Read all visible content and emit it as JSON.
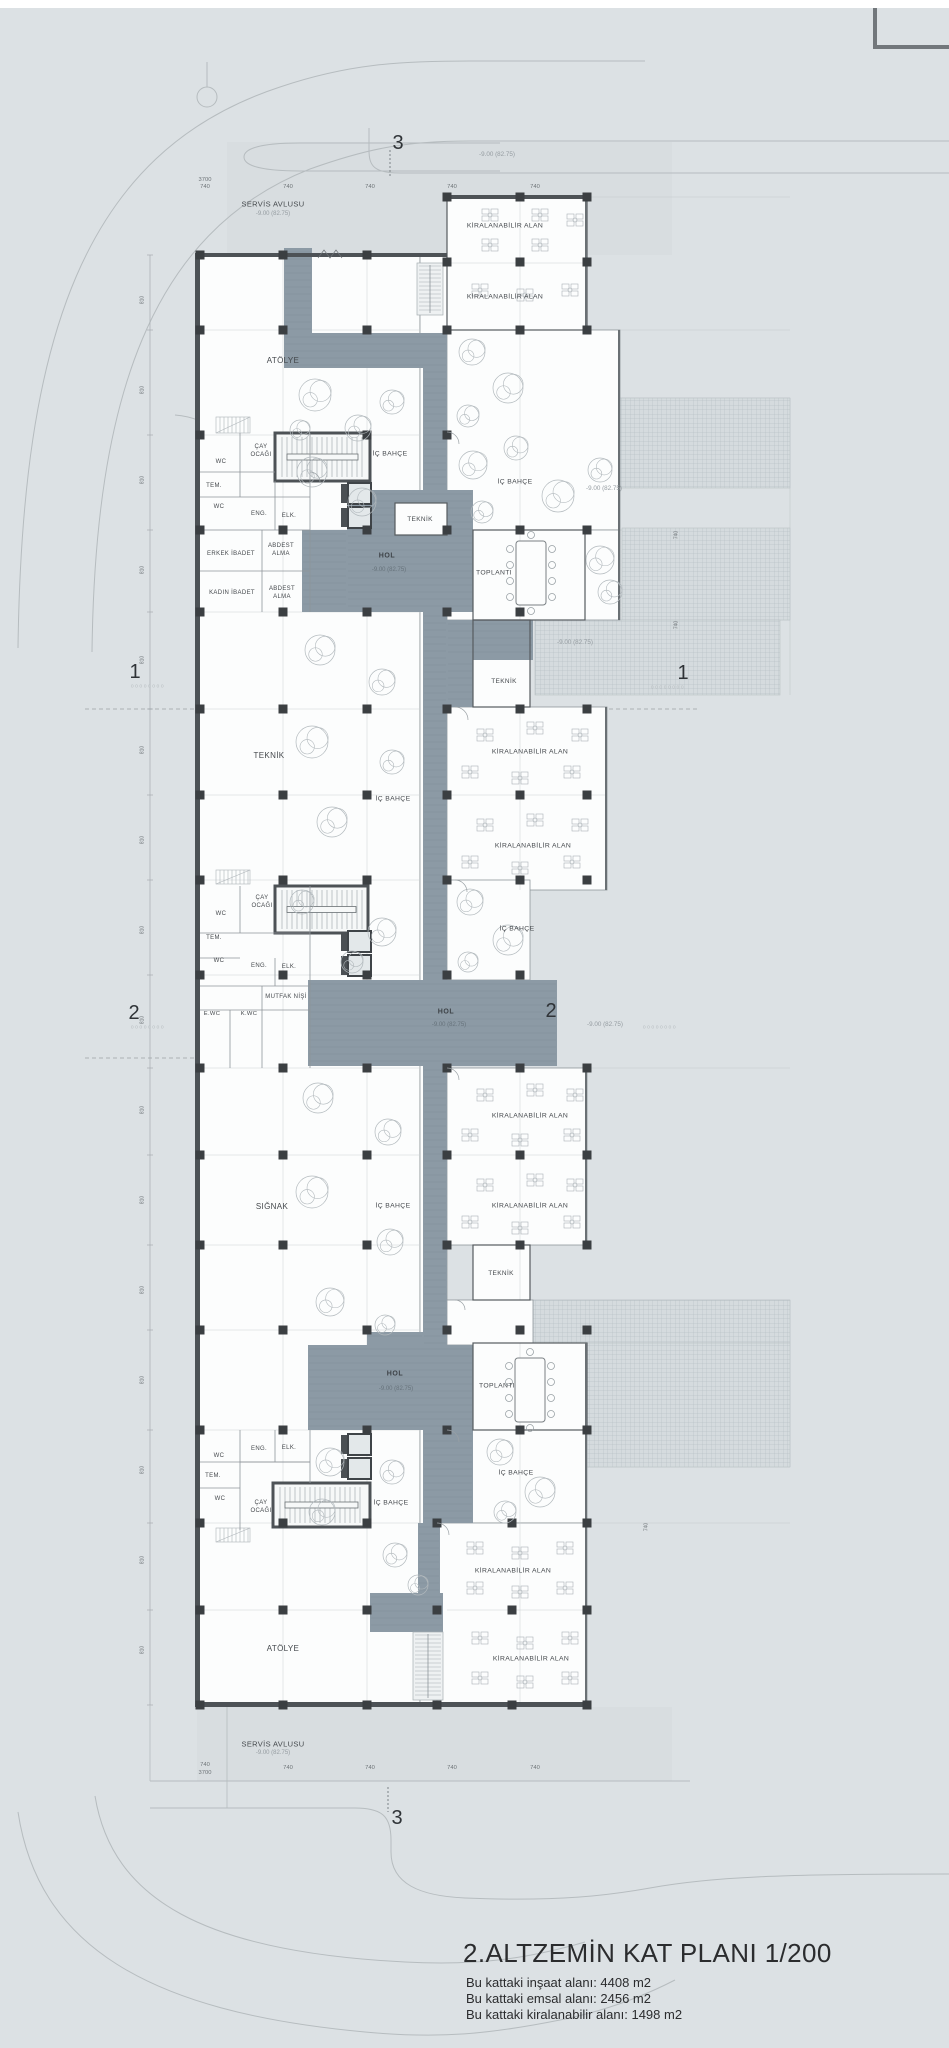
{
  "title_block": {
    "title": "2.ALTZEMİN KAT PLANI 1/200",
    "lines": [
      "Bu kattaki inşaat alanı: 4408 m2",
      "Bu kattaki emsal alanı: 2456 m2",
      "Bu kattaki kiralanabilir alanı: 1498 m2"
    ]
  },
  "colors": {
    "background": "#dce1e4",
    "room_fill": "#fcfdfd",
    "corridor": "#8c9aa5",
    "wall": "#4d5256",
    "column": "#3b3f42",
    "road_line": "#b6bcbf",
    "hatch_line": "#aeb7bc",
    "text": "#45494d"
  },
  "grid_markers": [
    {
      "t": "3",
      "x": 398,
      "y": 143
    },
    {
      "t": "3",
      "x": 397,
      "y": 1818
    },
    {
      "t": "1",
      "x": 135,
      "y": 672
    },
    {
      "t": "1",
      "x": 683,
      "y": 673
    },
    {
      "t": "2",
      "x": 134,
      "y": 1013
    },
    {
      "t": "2",
      "x": 551,
      "y": 1011
    }
  ],
  "labels": [
    {
      "t": "-9.00 (82.75)",
      "x": 497,
      "y": 155,
      "s": 6.3,
      "c": "muted"
    },
    {
      "t": "3700",
      "x": 205,
      "y": 181,
      "s": 5.8,
      "c": "dim"
    },
    {
      "t": "740",
      "x": 205,
      "y": 188,
      "s": 5.8,
      "c": "dim"
    },
    {
      "t": "740",
      "x": 288,
      "y": 188,
      "s": 5.8,
      "c": "dim"
    },
    {
      "t": "740",
      "x": 370,
      "y": 188,
      "s": 5.8,
      "c": "dim"
    },
    {
      "t": "740",
      "x": 452,
      "y": 188,
      "s": 5.8,
      "c": "dim"
    },
    {
      "t": "740",
      "x": 535,
      "y": 188,
      "s": 5.8,
      "c": "dim"
    },
    {
      "t": "SERVİS AVLUSU",
      "x": 273,
      "y": 204,
      "s": 7.5,
      "c": "room"
    },
    {
      "t": "-9.00 (82.75)",
      "x": 273,
      "y": 214,
      "s": 6,
      "c": "muted"
    },
    {
      "t": "KİRALANABİLİR ALAN",
      "x": 505,
      "y": 227,
      "s": 6.8,
      "c": "room"
    },
    {
      "t": "KİRALANABİLİR ALAN",
      "x": 505,
      "y": 298,
      "s": 6.8,
      "c": "room"
    },
    {
      "t": "ATÖLYE",
      "x": 283,
      "y": 361,
      "s": 8,
      "c": "room"
    },
    {
      "t": "İÇ BAHÇE",
      "x": 390,
      "y": 455,
      "s": 6.8,
      "c": "room"
    },
    {
      "t": "İÇ BAHÇE",
      "x": 515,
      "y": 483,
      "s": 6.8,
      "c": "room"
    },
    {
      "t": "ÇAY",
      "x": 261,
      "y": 447,
      "s": 6,
      "c": "room"
    },
    {
      "t": "OCAĞI",
      "x": 261,
      "y": 455,
      "s": 6,
      "c": "room"
    },
    {
      "t": "WC",
      "x": 221,
      "y": 462,
      "s": 6,
      "c": "room"
    },
    {
      "t": "TEM.",
      "x": 214,
      "y": 486,
      "s": 6,
      "c": "room"
    },
    {
      "t": "WC",
      "x": 219,
      "y": 507,
      "s": 6,
      "c": "room"
    },
    {
      "t": "ENG.",
      "x": 259,
      "y": 514,
      "s": 6,
      "c": "room"
    },
    {
      "t": "ELK.",
      "x": 289,
      "y": 516,
      "s": 6,
      "c": "room"
    },
    {
      "t": "TEKNİK",
      "x": 420,
      "y": 520,
      "s": 6.5,
      "c": "room"
    },
    {
      "t": "ERKEK İBADET",
      "x": 231,
      "y": 554,
      "s": 6,
      "c": "room"
    },
    {
      "t": "ABDEST",
      "x": 281,
      "y": 546,
      "s": 6,
      "c": "room"
    },
    {
      "t": "ALMA",
      "x": 281,
      "y": 554,
      "s": 6,
      "c": "room"
    },
    {
      "t": "KADIN İBADET",
      "x": 232,
      "y": 593,
      "s": 6,
      "c": "room"
    },
    {
      "t": "ABDEST",
      "x": 282,
      "y": 589,
      "s": 6,
      "c": "room"
    },
    {
      "t": "ALMA",
      "x": 282,
      "y": 597,
      "s": 6,
      "c": "room"
    },
    {
      "t": "HOL",
      "x": 387,
      "y": 556,
      "s": 7,
      "c": "hol"
    },
    {
      "t": "-9.00 (82.75)",
      "x": 389,
      "y": 570,
      "s": 6,
      "c": "holmuted"
    },
    {
      "t": "TOPLANTI",
      "x": 494,
      "y": 574,
      "s": 6.8,
      "c": "room"
    },
    {
      "t": "-9.00 (82.75)",
      "x": 604,
      "y": 489,
      "s": 6.3,
      "c": "muted"
    },
    {
      "t": "-9.00 (82.75)",
      "x": 575,
      "y": 643,
      "s": 6.3,
      "c": "muted"
    },
    {
      "t": "TEKNİK",
      "x": 269,
      "y": 756,
      "s": 8,
      "c": "room"
    },
    {
      "t": "TEKNİK",
      "x": 504,
      "y": 682,
      "s": 6.5,
      "c": "room"
    },
    {
      "t": "KİRALANABİLİR ALAN",
      "x": 530,
      "y": 753,
      "s": 6.8,
      "c": "room"
    },
    {
      "t": "KİRALANABİLİR ALAN",
      "x": 533,
      "y": 847,
      "s": 6.8,
      "c": "room"
    },
    {
      "t": "İÇ BAHÇE",
      "x": 393,
      "y": 800,
      "s": 6.8,
      "c": "room"
    },
    {
      "t": "İÇ BAHÇE",
      "x": 517,
      "y": 930,
      "s": 6.8,
      "c": "room"
    },
    {
      "t": "ÇAY",
      "x": 262,
      "y": 898,
      "s": 6,
      "c": "room"
    },
    {
      "t": "OCAĞI",
      "x": 262,
      "y": 906,
      "s": 6,
      "c": "room"
    },
    {
      "t": "WC",
      "x": 221,
      "y": 914,
      "s": 6,
      "c": "room"
    },
    {
      "t": "TEM.",
      "x": 214,
      "y": 938,
      "s": 6,
      "c": "room"
    },
    {
      "t": "WC",
      "x": 219,
      "y": 961,
      "s": 6,
      "c": "room"
    },
    {
      "t": "ENG.",
      "x": 259,
      "y": 966,
      "s": 6,
      "c": "room"
    },
    {
      "t": "ELK.",
      "x": 289,
      "y": 967,
      "s": 6,
      "c": "room"
    },
    {
      "t": "MUTFAK NİŞİ",
      "x": 286,
      "y": 997,
      "s": 6,
      "c": "room"
    },
    {
      "t": "E.WC",
      "x": 212,
      "y": 1015,
      "s": 5.8,
      "c": "room"
    },
    {
      "t": "K.WC",
      "x": 249,
      "y": 1015,
      "s": 5.8,
      "c": "room"
    },
    {
      "t": "HOL",
      "x": 446,
      "y": 1012,
      "s": 7,
      "c": "hol"
    },
    {
      "t": "-9.00 (82.75)",
      "x": 449,
      "y": 1025,
      "s": 6,
      "c": "holmuted"
    },
    {
      "t": "-9.00 (82.75)",
      "x": 605,
      "y": 1025,
      "s": 6.3,
      "c": "muted"
    },
    {
      "t": "SIĞNAK",
      "x": 272,
      "y": 1207,
      "s": 8,
      "c": "room"
    },
    {
      "t": "İÇ BAHÇE",
      "x": 393,
      "y": 1207,
      "s": 6.8,
      "c": "room"
    },
    {
      "t": "KİRALANABİLİR ALAN",
      "x": 530,
      "y": 1117,
      "s": 6.8,
      "c": "room"
    },
    {
      "t": "KİRALANABİLİR ALAN",
      "x": 530,
      "y": 1207,
      "s": 6.8,
      "c": "room"
    },
    {
      "t": "TEKNİK",
      "x": 501,
      "y": 1274,
      "s": 6.5,
      "c": "room"
    },
    {
      "t": "HOL",
      "x": 395,
      "y": 1374,
      "s": 7,
      "c": "hol"
    },
    {
      "t": "-9.00 (82.75)",
      "x": 396,
      "y": 1389,
      "s": 6,
      "c": "holmuted"
    },
    {
      "t": "TOPLANTI",
      "x": 497,
      "y": 1387,
      "s": 6.8,
      "c": "room"
    },
    {
      "t": "İÇ BAHÇE",
      "x": 516,
      "y": 1474,
      "s": 6.8,
      "c": "room"
    },
    {
      "t": "İÇ BAHÇE",
      "x": 391,
      "y": 1504,
      "s": 6.8,
      "c": "room"
    },
    {
      "t": "ENG.",
      "x": 259,
      "y": 1449,
      "s": 6,
      "c": "room"
    },
    {
      "t": "ELK.",
      "x": 289,
      "y": 1448,
      "s": 6,
      "c": "room"
    },
    {
      "t": "WC",
      "x": 219,
      "y": 1456,
      "s": 6,
      "c": "room"
    },
    {
      "t": "TEM.",
      "x": 213,
      "y": 1476,
      "s": 6,
      "c": "room"
    },
    {
      "t": "WC",
      "x": 220,
      "y": 1499,
      "s": 6,
      "c": "room"
    },
    {
      "t": "ÇAY",
      "x": 261,
      "y": 1503,
      "s": 6,
      "c": "room"
    },
    {
      "t": "OCAĞI",
      "x": 261,
      "y": 1511,
      "s": 6,
      "c": "room"
    },
    {
      "t": "KİRALANABİLİR ALAN",
      "x": 513,
      "y": 1572,
      "s": 6.8,
      "c": "room"
    },
    {
      "t": "KİRALANABİLİR ALAN",
      "x": 531,
      "y": 1660,
      "s": 6.8,
      "c": "room"
    },
    {
      "t": "ATÖLYE",
      "x": 283,
      "y": 1649,
      "s": 8,
      "c": "room"
    },
    {
      "t": "SERVİS AVLUSU",
      "x": 273,
      "y": 1744,
      "s": 7.5,
      "c": "room"
    },
    {
      "t": "-9.00 (82.75)",
      "x": 273,
      "y": 1753,
      "s": 6,
      "c": "muted"
    },
    {
      "t": "740",
      "x": 205,
      "y": 1766,
      "s": 5.8,
      "c": "dim"
    },
    {
      "t": "3700",
      "x": 205,
      "y": 1774,
      "s": 5.8,
      "c": "dim"
    },
    {
      "t": "740",
      "x": 288,
      "y": 1769,
      "s": 5.8,
      "c": "dim"
    },
    {
      "t": "740",
      "x": 370,
      "y": 1769,
      "s": 5.8,
      "c": "dim"
    },
    {
      "t": "740",
      "x": 452,
      "y": 1769,
      "s": 5.8,
      "c": "dim"
    },
    {
      "t": "740",
      "x": 535,
      "y": 1769,
      "s": 5.8,
      "c": "dim"
    },
    {
      "t": "oooooooo",
      "x": 148,
      "y": 687,
      "s": 5,
      "c": "dots"
    },
    {
      "t": "oooooooo",
      "x": 668,
      "y": 688,
      "s": 5,
      "c": "dots"
    },
    {
      "t": "oooooooo",
      "x": 148,
      "y": 1028,
      "s": 5,
      "c": "dots"
    },
    {
      "t": "oooooooo",
      "x": 660,
      "y": 1028,
      "s": 5,
      "c": "dots"
    }
  ],
  "rotated_dims": [
    {
      "t": "810",
      "x": 143,
      "y": 300
    },
    {
      "t": "810",
      "x": 143,
      "y": 390
    },
    {
      "t": "810",
      "x": 143,
      "y": 480
    },
    {
      "t": "810",
      "x": 143,
      "y": 570
    },
    {
      "t": "810",
      "x": 143,
      "y": 660
    },
    {
      "t": "810",
      "x": 143,
      "y": 750
    },
    {
      "t": "810",
      "x": 143,
      "y": 840
    },
    {
      "t": "810",
      "x": 143,
      "y": 930
    },
    {
      "t": "810",
      "x": 143,
      "y": 1020
    },
    {
      "t": "810",
      "x": 143,
      "y": 1110
    },
    {
      "t": "810",
      "x": 143,
      "y": 1200
    },
    {
      "t": "810",
      "x": 143,
      "y": 1290
    },
    {
      "t": "810",
      "x": 143,
      "y": 1380
    },
    {
      "t": "810",
      "x": 143,
      "y": 1470
    },
    {
      "t": "810",
      "x": 143,
      "y": 1560
    },
    {
      "t": "810",
      "x": 143,
      "y": 1650
    },
    {
      "t": "740",
      "x": 677,
      "y": 535
    },
    {
      "t": "740",
      "x": 677,
      "y": 625
    },
    {
      "t": "740",
      "x": 647,
      "y": 1527
    }
  ]
}
